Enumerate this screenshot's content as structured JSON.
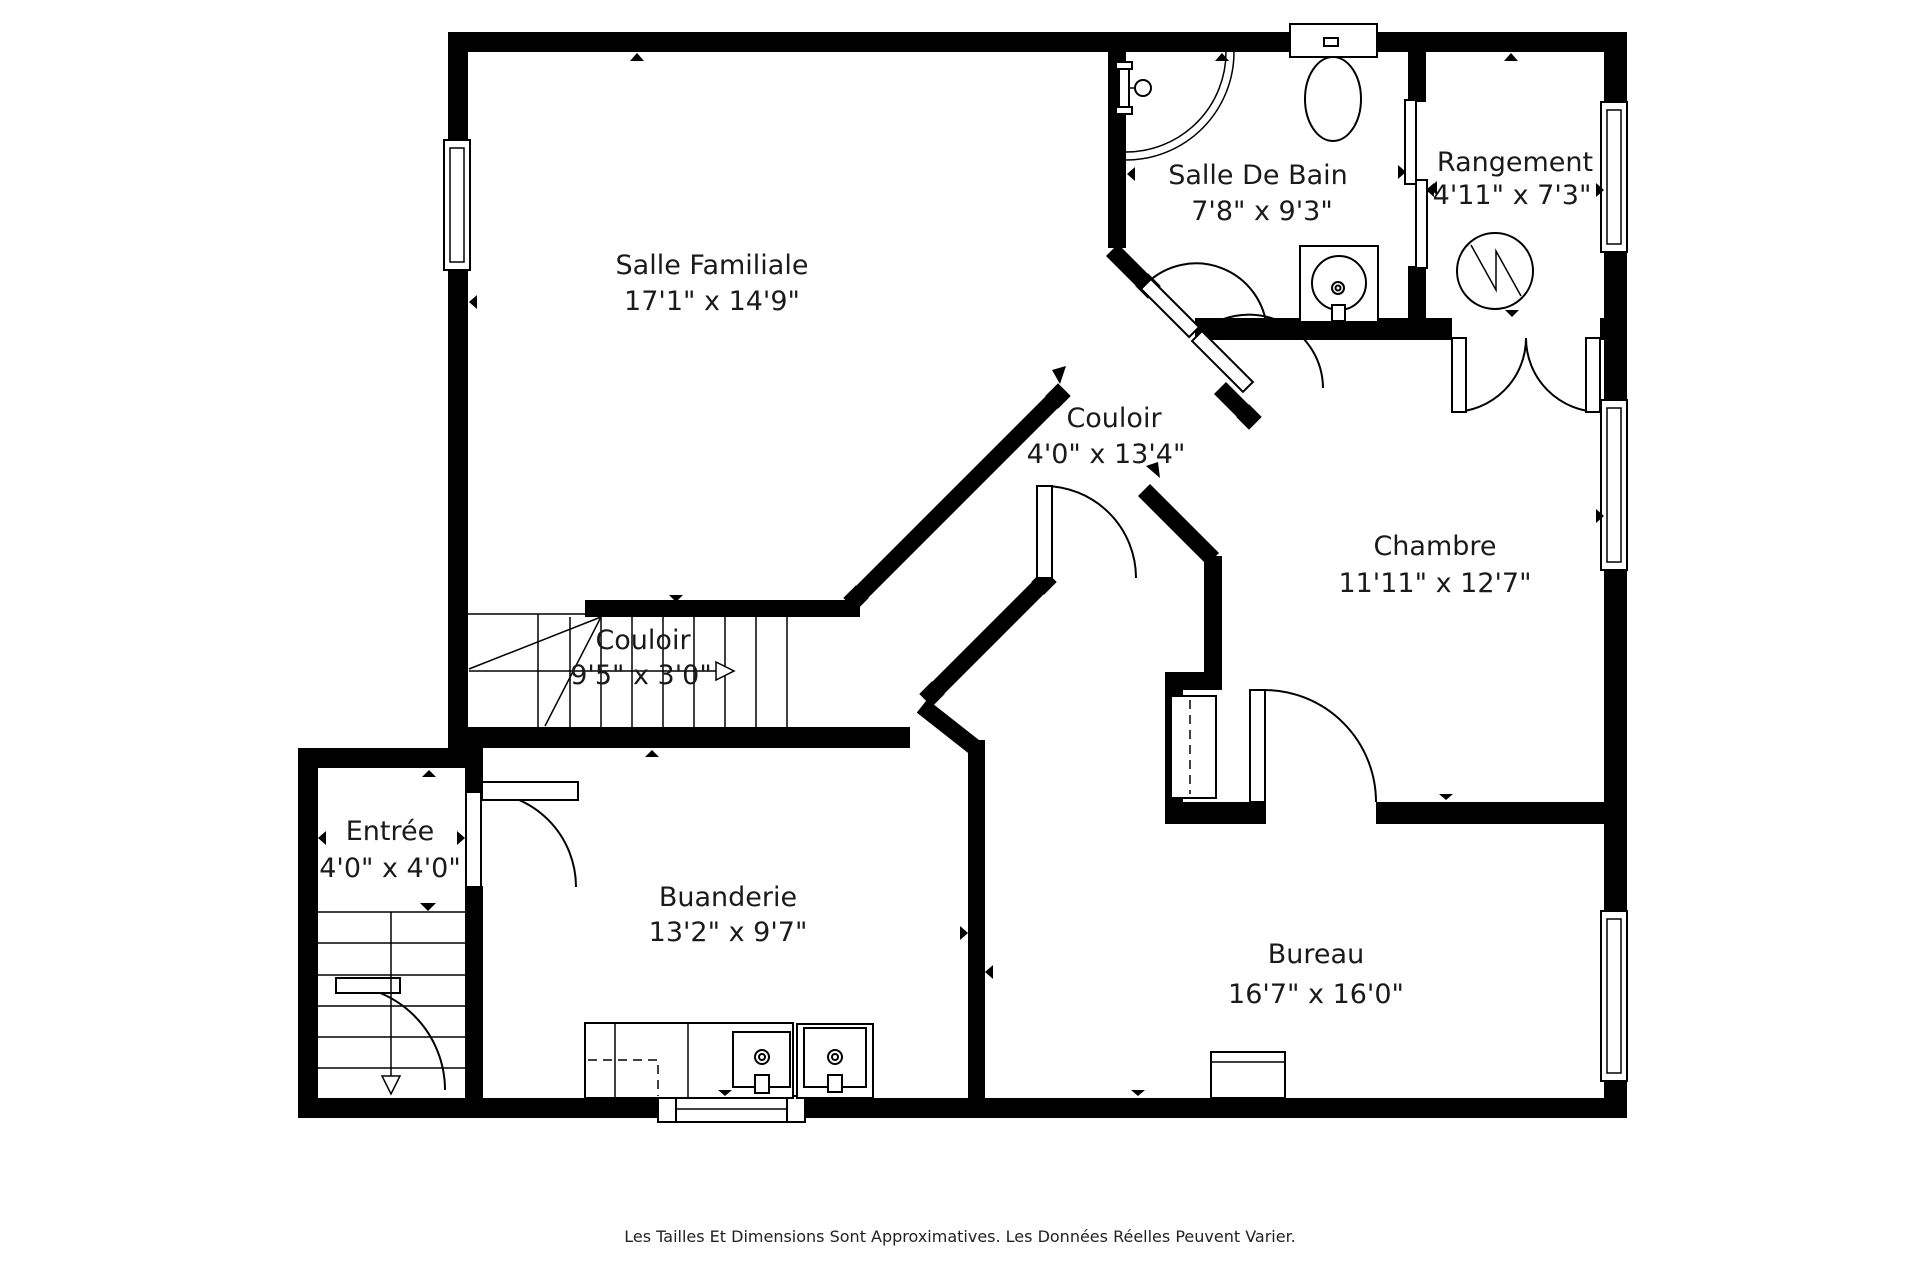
{
  "floorplan": {
    "colors": {
      "wall": "#000000",
      "text": "#1a1a1a",
      "background": "#ffffff"
    },
    "rooms": [
      {
        "id": "salle-familiale",
        "name": "Salle Familiale",
        "dims": "17'1\" x 14'9\""
      },
      {
        "id": "salle-de-bain",
        "name": "Salle De Bain",
        "dims": "7'8\" x 9'3\""
      },
      {
        "id": "rangement",
        "name": "Rangement",
        "dims": "4'11\" x 7'3\""
      },
      {
        "id": "couloir-diagonal",
        "name": "Couloir",
        "dims": "4'0\" x 13'4\""
      },
      {
        "id": "chambre",
        "name": "Chambre",
        "dims": "11'11\" x 12'7\""
      },
      {
        "id": "couloir-stairs",
        "name": "Couloir",
        "dims": "9'5\" x 3'0\""
      },
      {
        "id": "entree",
        "name": "Entrée",
        "dims": "4'0\" x 4'0\""
      },
      {
        "id": "buanderie",
        "name": "Buanderie",
        "dims": "13'2\" x 9'7\""
      },
      {
        "id": "bureau",
        "name": "Bureau",
        "dims": "16'7\" x 16'0\""
      }
    ],
    "fixtures": [
      "shower-icon",
      "shower-head-icon",
      "toilet-icon",
      "bathroom-sink-icon",
      "water-heater-icon",
      "pocket-door-icon",
      "double-door-icon",
      "stairs-up-icon",
      "stairs-down-icon",
      "closet-icon",
      "laundry-counter-icon",
      "laundry-sink-icon",
      "washer-icon",
      "desk-icon",
      "window-icon",
      "door-swing-icon"
    ],
    "disclaimer": "Les Tailles Et Dimensions Sont Approximatives. Les Données Réelles Peuvent Varier."
  }
}
